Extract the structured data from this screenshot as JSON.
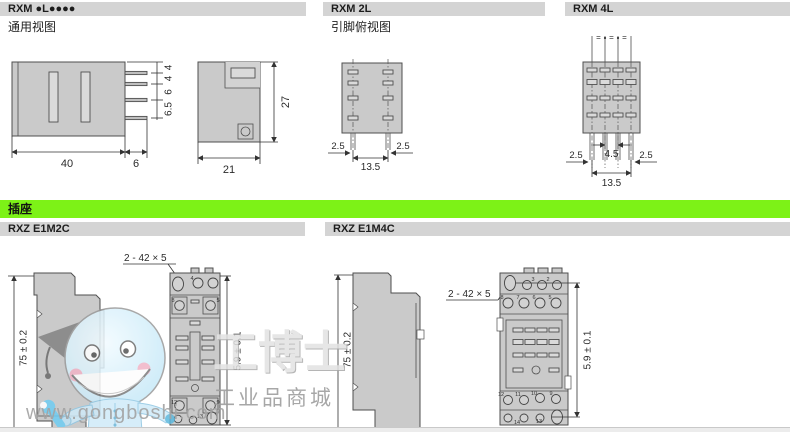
{
  "header": {
    "col1_title": "RXM ●L●●●●",
    "col1_subtitle": "通用视图",
    "col2_title": "RXM 2L",
    "col2_subtitle": "引脚俯视图",
    "col3_title": "RXM 4L"
  },
  "socket": {
    "band_label": "插座",
    "col1_title": "RXZ E1M2C",
    "col2_title": "RXZ E1M4C"
  },
  "dims": {
    "relay_front": {
      "width": "40",
      "pin_len": "6",
      "pitch": [
        "4",
        "4",
        "6",
        "6.5"
      ]
    },
    "relay_side": {
      "depth": "21",
      "height": "27"
    },
    "rxm2l": {
      "left": "2.5",
      "right": "2.5",
      "span": "13.5"
    },
    "rxm4l": {
      "center": "4.5",
      "left": "2.5",
      "right": "2.5",
      "span": "13.5",
      "equal_mark": "="
    },
    "rxze1m2c": {
      "height": "75 ± 0.2",
      "slot": "2 - 42 × 5",
      "window": "5.9 ± 0.1"
    },
    "rxze1m4c": {
      "height": "75 ± 0.2",
      "slot": "2 - 42 × 5",
      "window": "5.9 ± 0.1"
    }
  },
  "terminals": {
    "rxze1m2c": {
      "top": [
        "4",
        "8",
        "5"
      ],
      "bottom": [
        "12",
        "9",
        "13"
      ]
    },
    "rxze1m4c": {
      "row1": [
        "3",
        "2"
      ],
      "row2": [
        "8",
        "7",
        "6",
        "5"
      ],
      "row3": [
        "12",
        "11",
        "10",
        "9"
      ],
      "row4": [
        "14",
        "13"
      ]
    }
  },
  "watermark": {
    "brand": "工博士",
    "tagline": "工业品商城",
    "url": "www.gongboshi.com"
  },
  "colors": {
    "accent_green": "#7DF217",
    "header_bar": "#D4D4D4",
    "drawing_fill": "#CACACA",
    "line_color": "#4F4F4F"
  }
}
